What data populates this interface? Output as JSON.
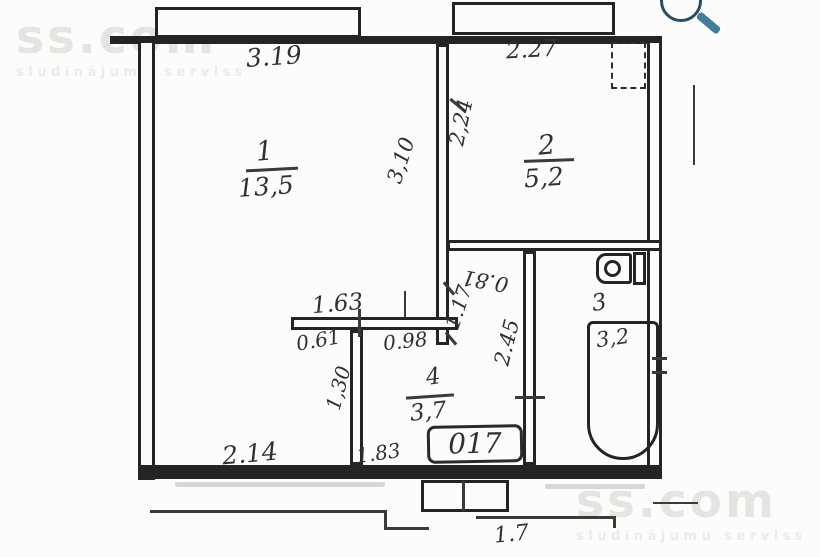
{
  "watermarks": {
    "brand": "ss.com",
    "tagline": "sludinājumu serviss"
  },
  "plan": {
    "apartment_number": "017",
    "rooms": [
      {
        "number": "1",
        "area": "13,5"
      },
      {
        "number": "2",
        "area": "5,2"
      },
      {
        "number": "3",
        "area": "3,2"
      },
      {
        "number": "4",
        "area": "3,7"
      }
    ],
    "dimensions": {
      "balcony_left_width": "3.19",
      "balcony_right_width": "2.27",
      "room1_depth": "3,10",
      "room2_left_wall": "2,24",
      "hall_top_wall": "0.81",
      "door_opening": "1.17",
      "hall_depth": "2.45",
      "closet_wall_total": "1.63",
      "closet_left": "0.61",
      "closet_right": "0.98",
      "partition_height": "1,30",
      "hall_bottom_width": "1.83",
      "room1_bottom_width": "2.14",
      "entry_step_width": "1.7"
    }
  },
  "icons": {
    "magnifier": "zoom-in",
    "toilet": "toilet-icon",
    "bathtub": "bathtub-icon",
    "vent": "vent-shaft"
  },
  "colors": {
    "ink": "#303030",
    "wall": "#242424",
    "watermark": "#e4e4e1",
    "magnifier_handle": "#3f7e96"
  }
}
